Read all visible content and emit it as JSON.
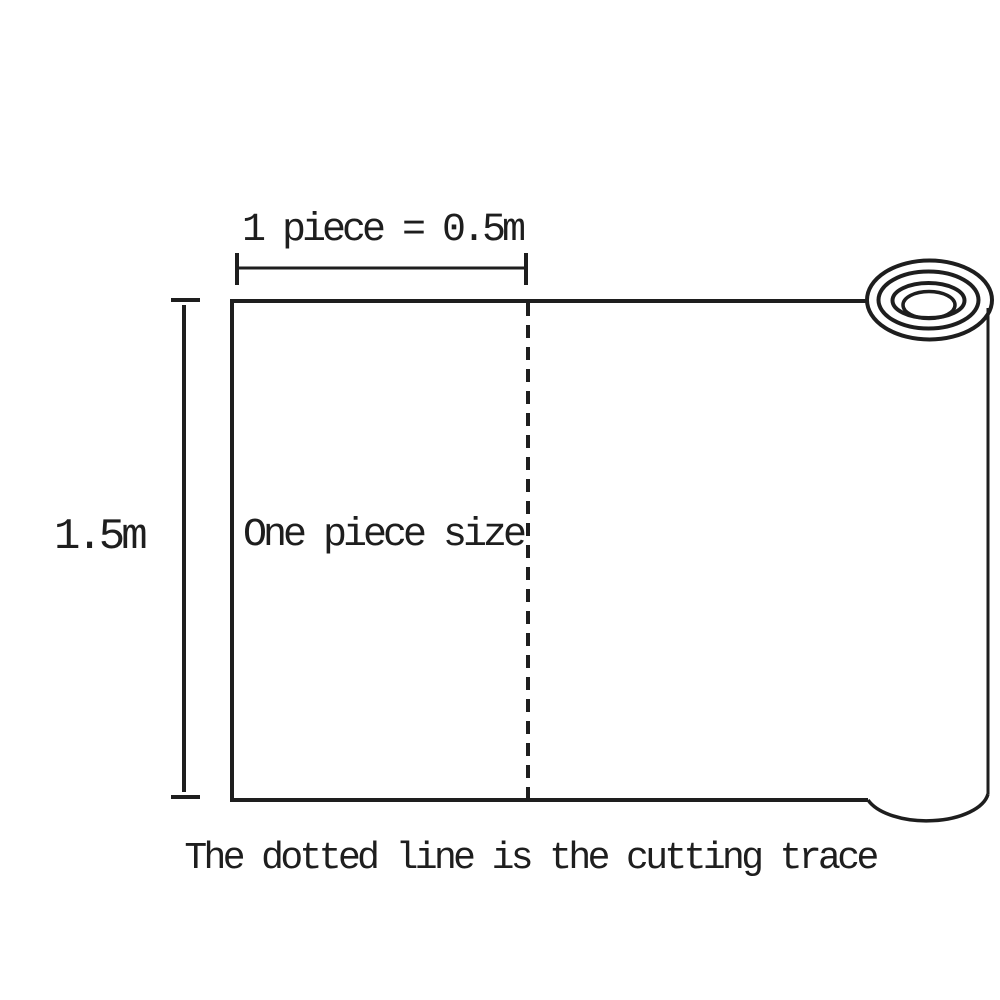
{
  "diagram": {
    "type": "product-size-illustration",
    "subject": "rolled sheet with cutting guide",
    "labels": {
      "piece_width": "1 piece = 0.5m",
      "roll_height": "1.5m",
      "piece_area": "One piece size",
      "caption": "The dotted line is the cutting trace"
    },
    "dimensions": {
      "piece_length_m": 0.5,
      "roll_width_m": 1.5
    },
    "colors": {
      "line": "#1e1e1e",
      "background": "#ffffff"
    }
  }
}
